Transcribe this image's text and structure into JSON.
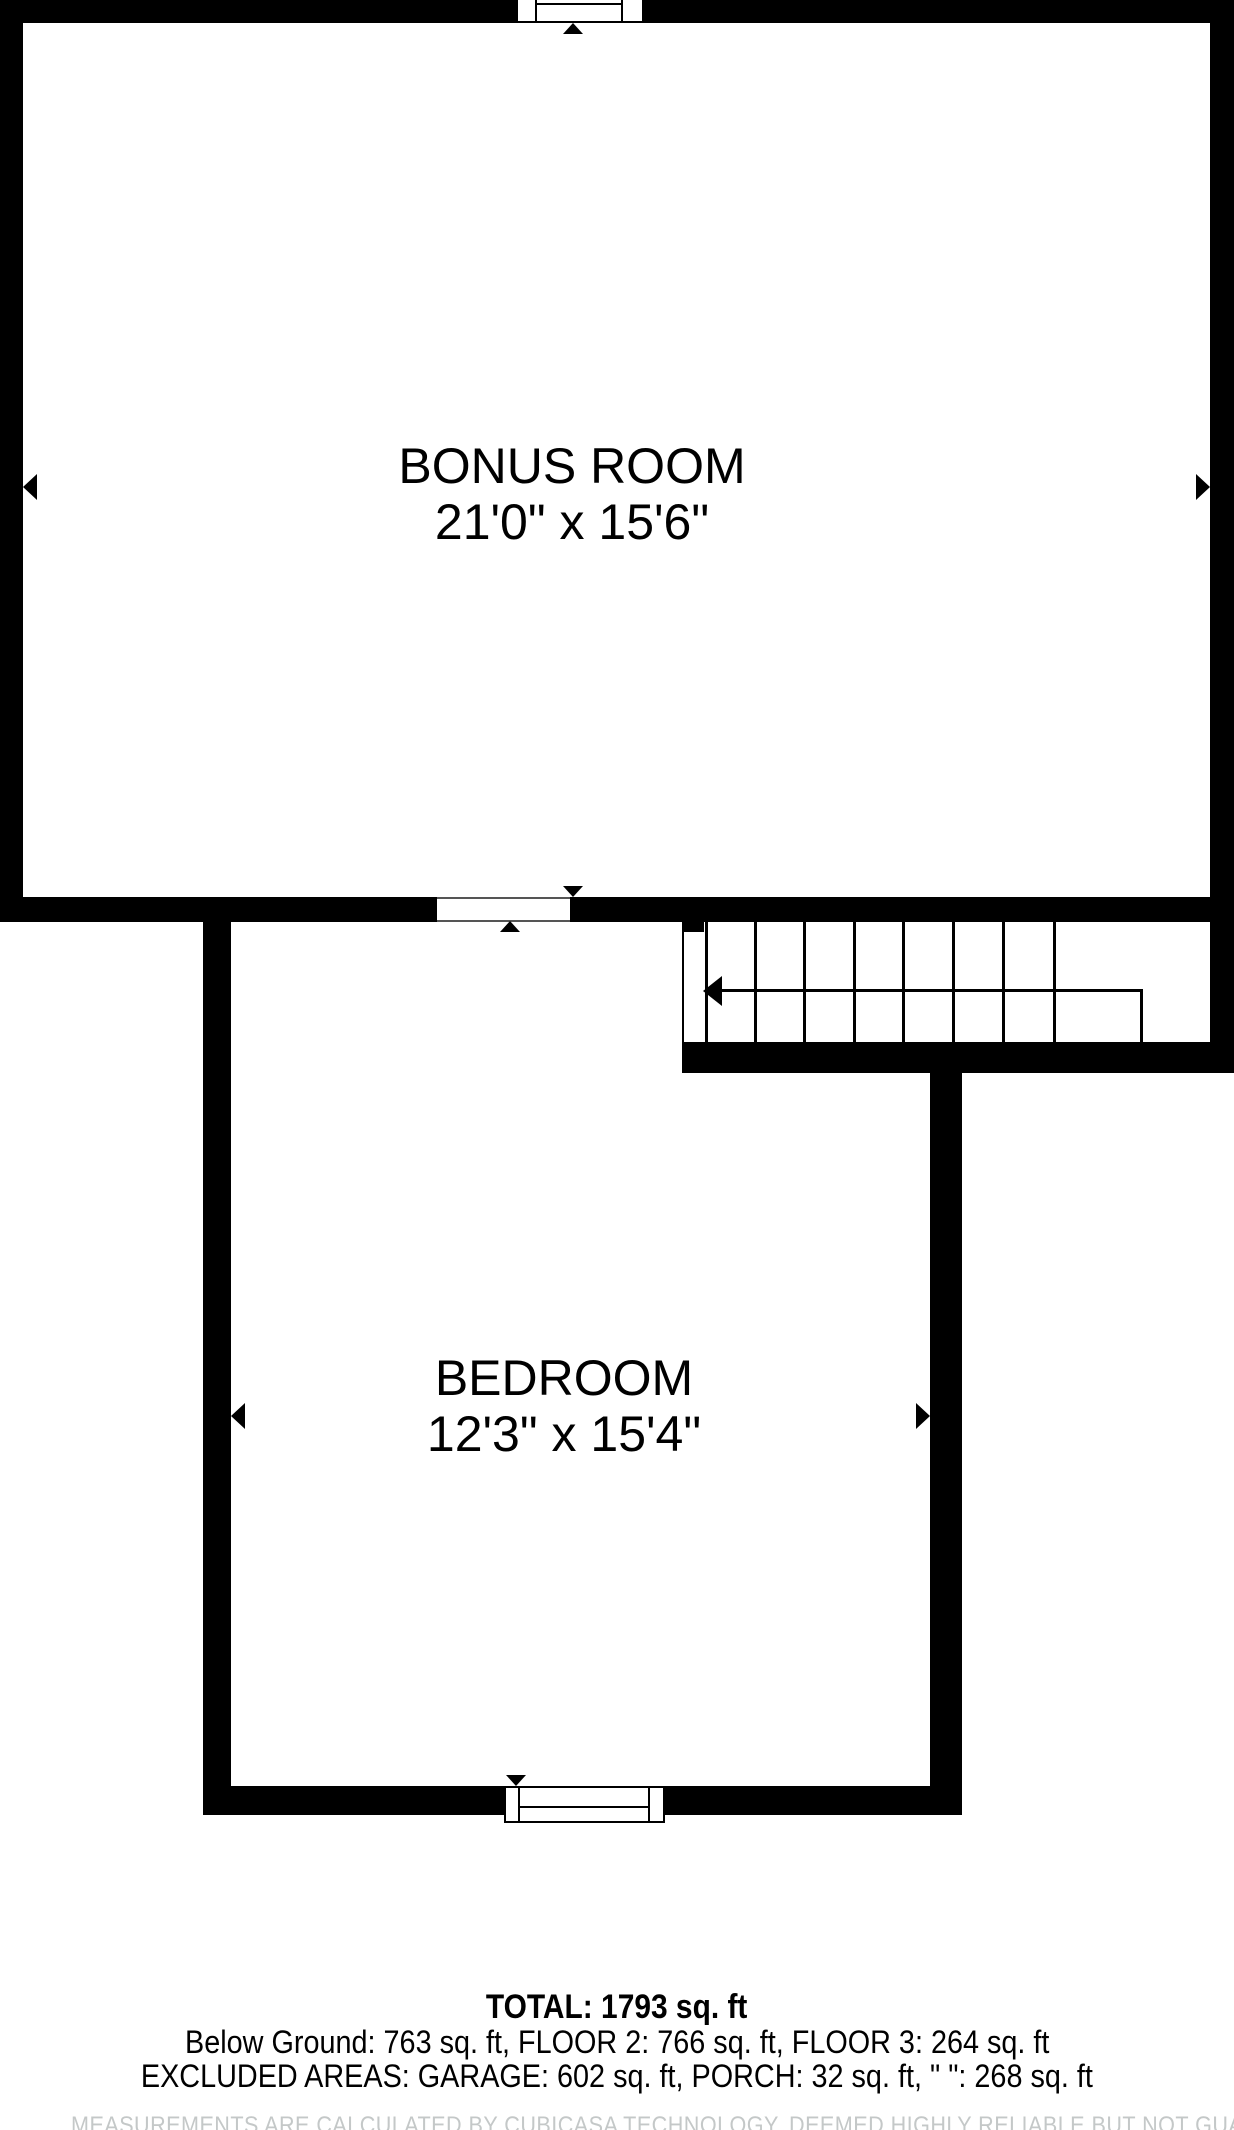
{
  "floorplan": {
    "rooms": [
      {
        "name": "BONUS ROOM",
        "dimensions": "21'0\" x 15'6\""
      },
      {
        "name": "BEDROOM",
        "dimensions": "12'3\" x 15'4\""
      }
    ],
    "summary": {
      "total": "TOTAL: 1793 sq. ft",
      "floor_breakdown": "Below Ground: 763 sq. ft, FLOOR 2: 766 sq. ft, FLOOR 3: 264 sq. ft",
      "excluded_areas": "EXCLUDED AREAS: GARAGE: 602 sq. ft, PORCH: 32 sq. ft, \" \": 268 sq. ft",
      "disclaimer": "MEASUREMENTS ARE CALCULATED BY CUBICASA TECHNOLOGY, DEEMED HIGHLY RELIABLE BUT NOT GUARANTEED"
    },
    "colors": {
      "wall": "#000000",
      "background": "#ffffff",
      "disclaimer_text": "#c4c8c8"
    }
  }
}
